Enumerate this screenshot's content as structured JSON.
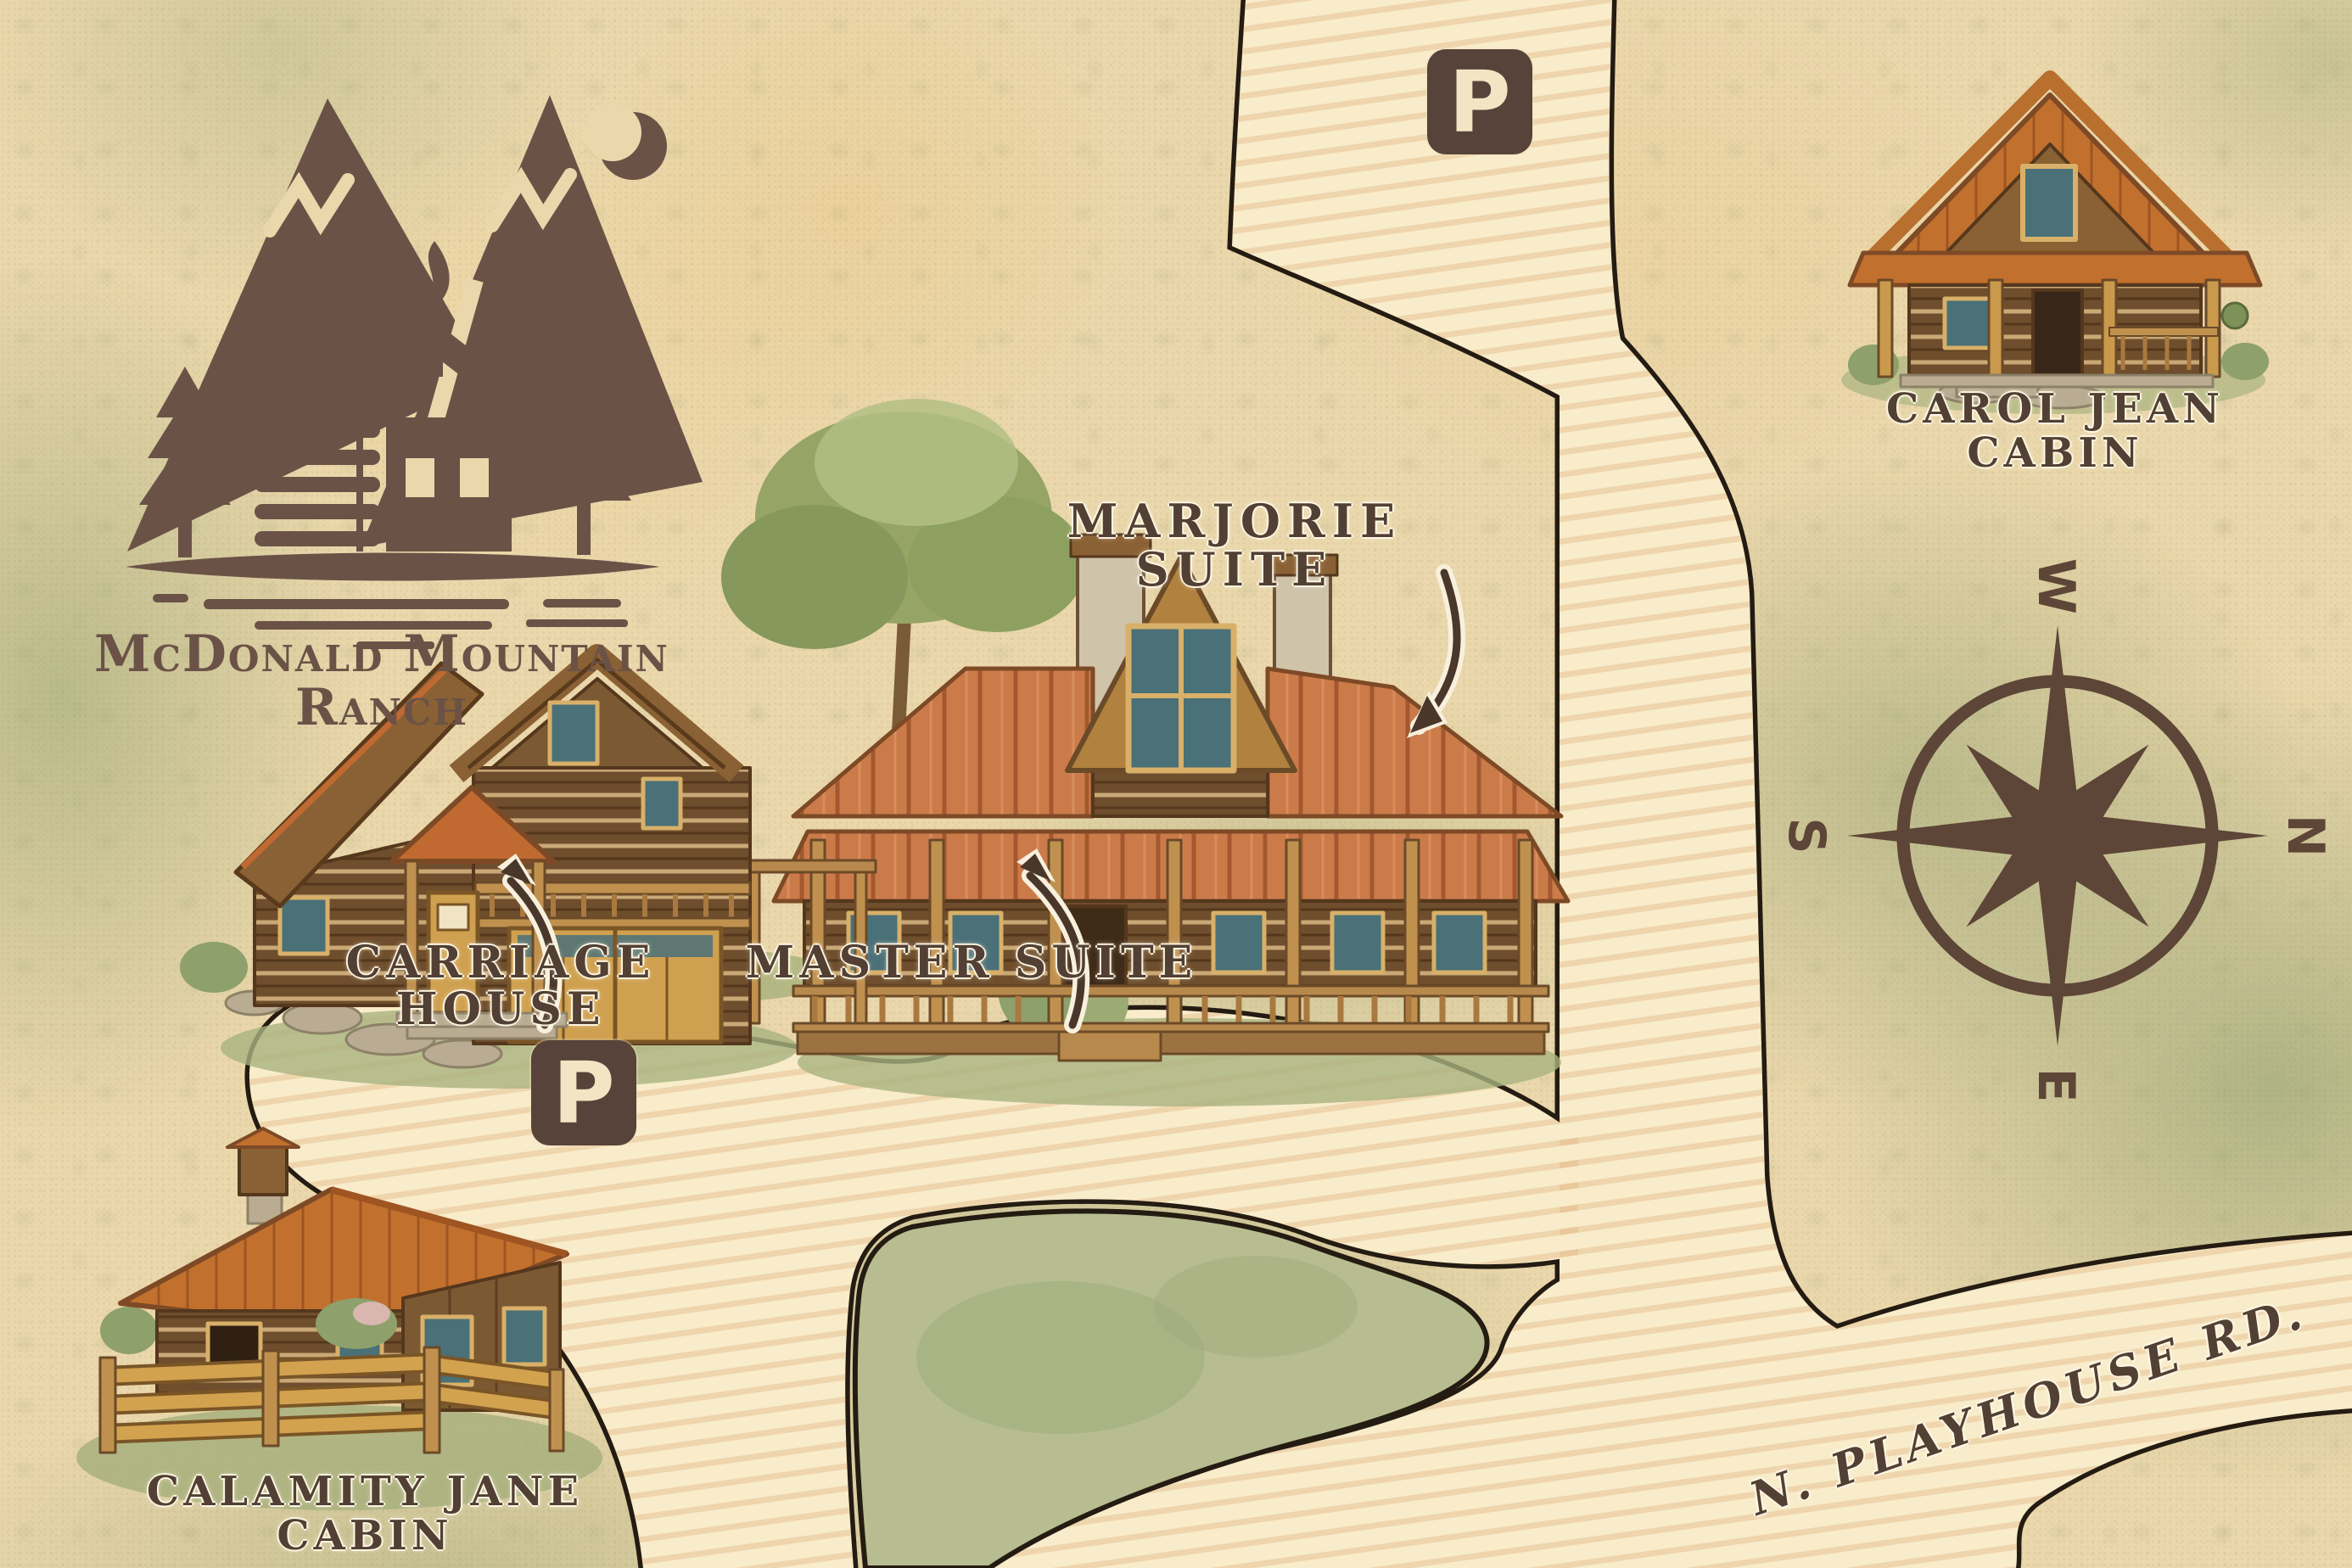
{
  "logo": {
    "title": "McDonald Mountain Ranch"
  },
  "labels": {
    "marjorie_suite": "MARJORIE SUITE",
    "carriage_house": "CARRIAGE HOUSE",
    "master_suite": "MASTER SUITE",
    "calamity_jane_line1": "CALAMITY JANE",
    "calamity_jane_line2": "CABIN",
    "carol_jean_line1": "CAROL JEAN",
    "carol_jean_line2": "CABIN",
    "road_name": "N. PLAYHOUSE RD."
  },
  "parking": {
    "symbol": "P"
  },
  "compass": {
    "north": "N",
    "east": "E",
    "south": "S",
    "west": "W",
    "rotation_deg": 90
  },
  "colors": {
    "ink_brown": "#524034",
    "logo_brown": "#6b5247",
    "parchment": "#ead7ab",
    "moss_green": "#a9b37f",
    "road_cream": "#f8ecca",
    "road_outline": "#241c12",
    "roof_copper": "#cb7b49",
    "roof_orange": "#c2702e",
    "timber_gold": "#cfa04f",
    "log_brown": "#6e4e2d",
    "window_teal": "#4a7078"
  }
}
